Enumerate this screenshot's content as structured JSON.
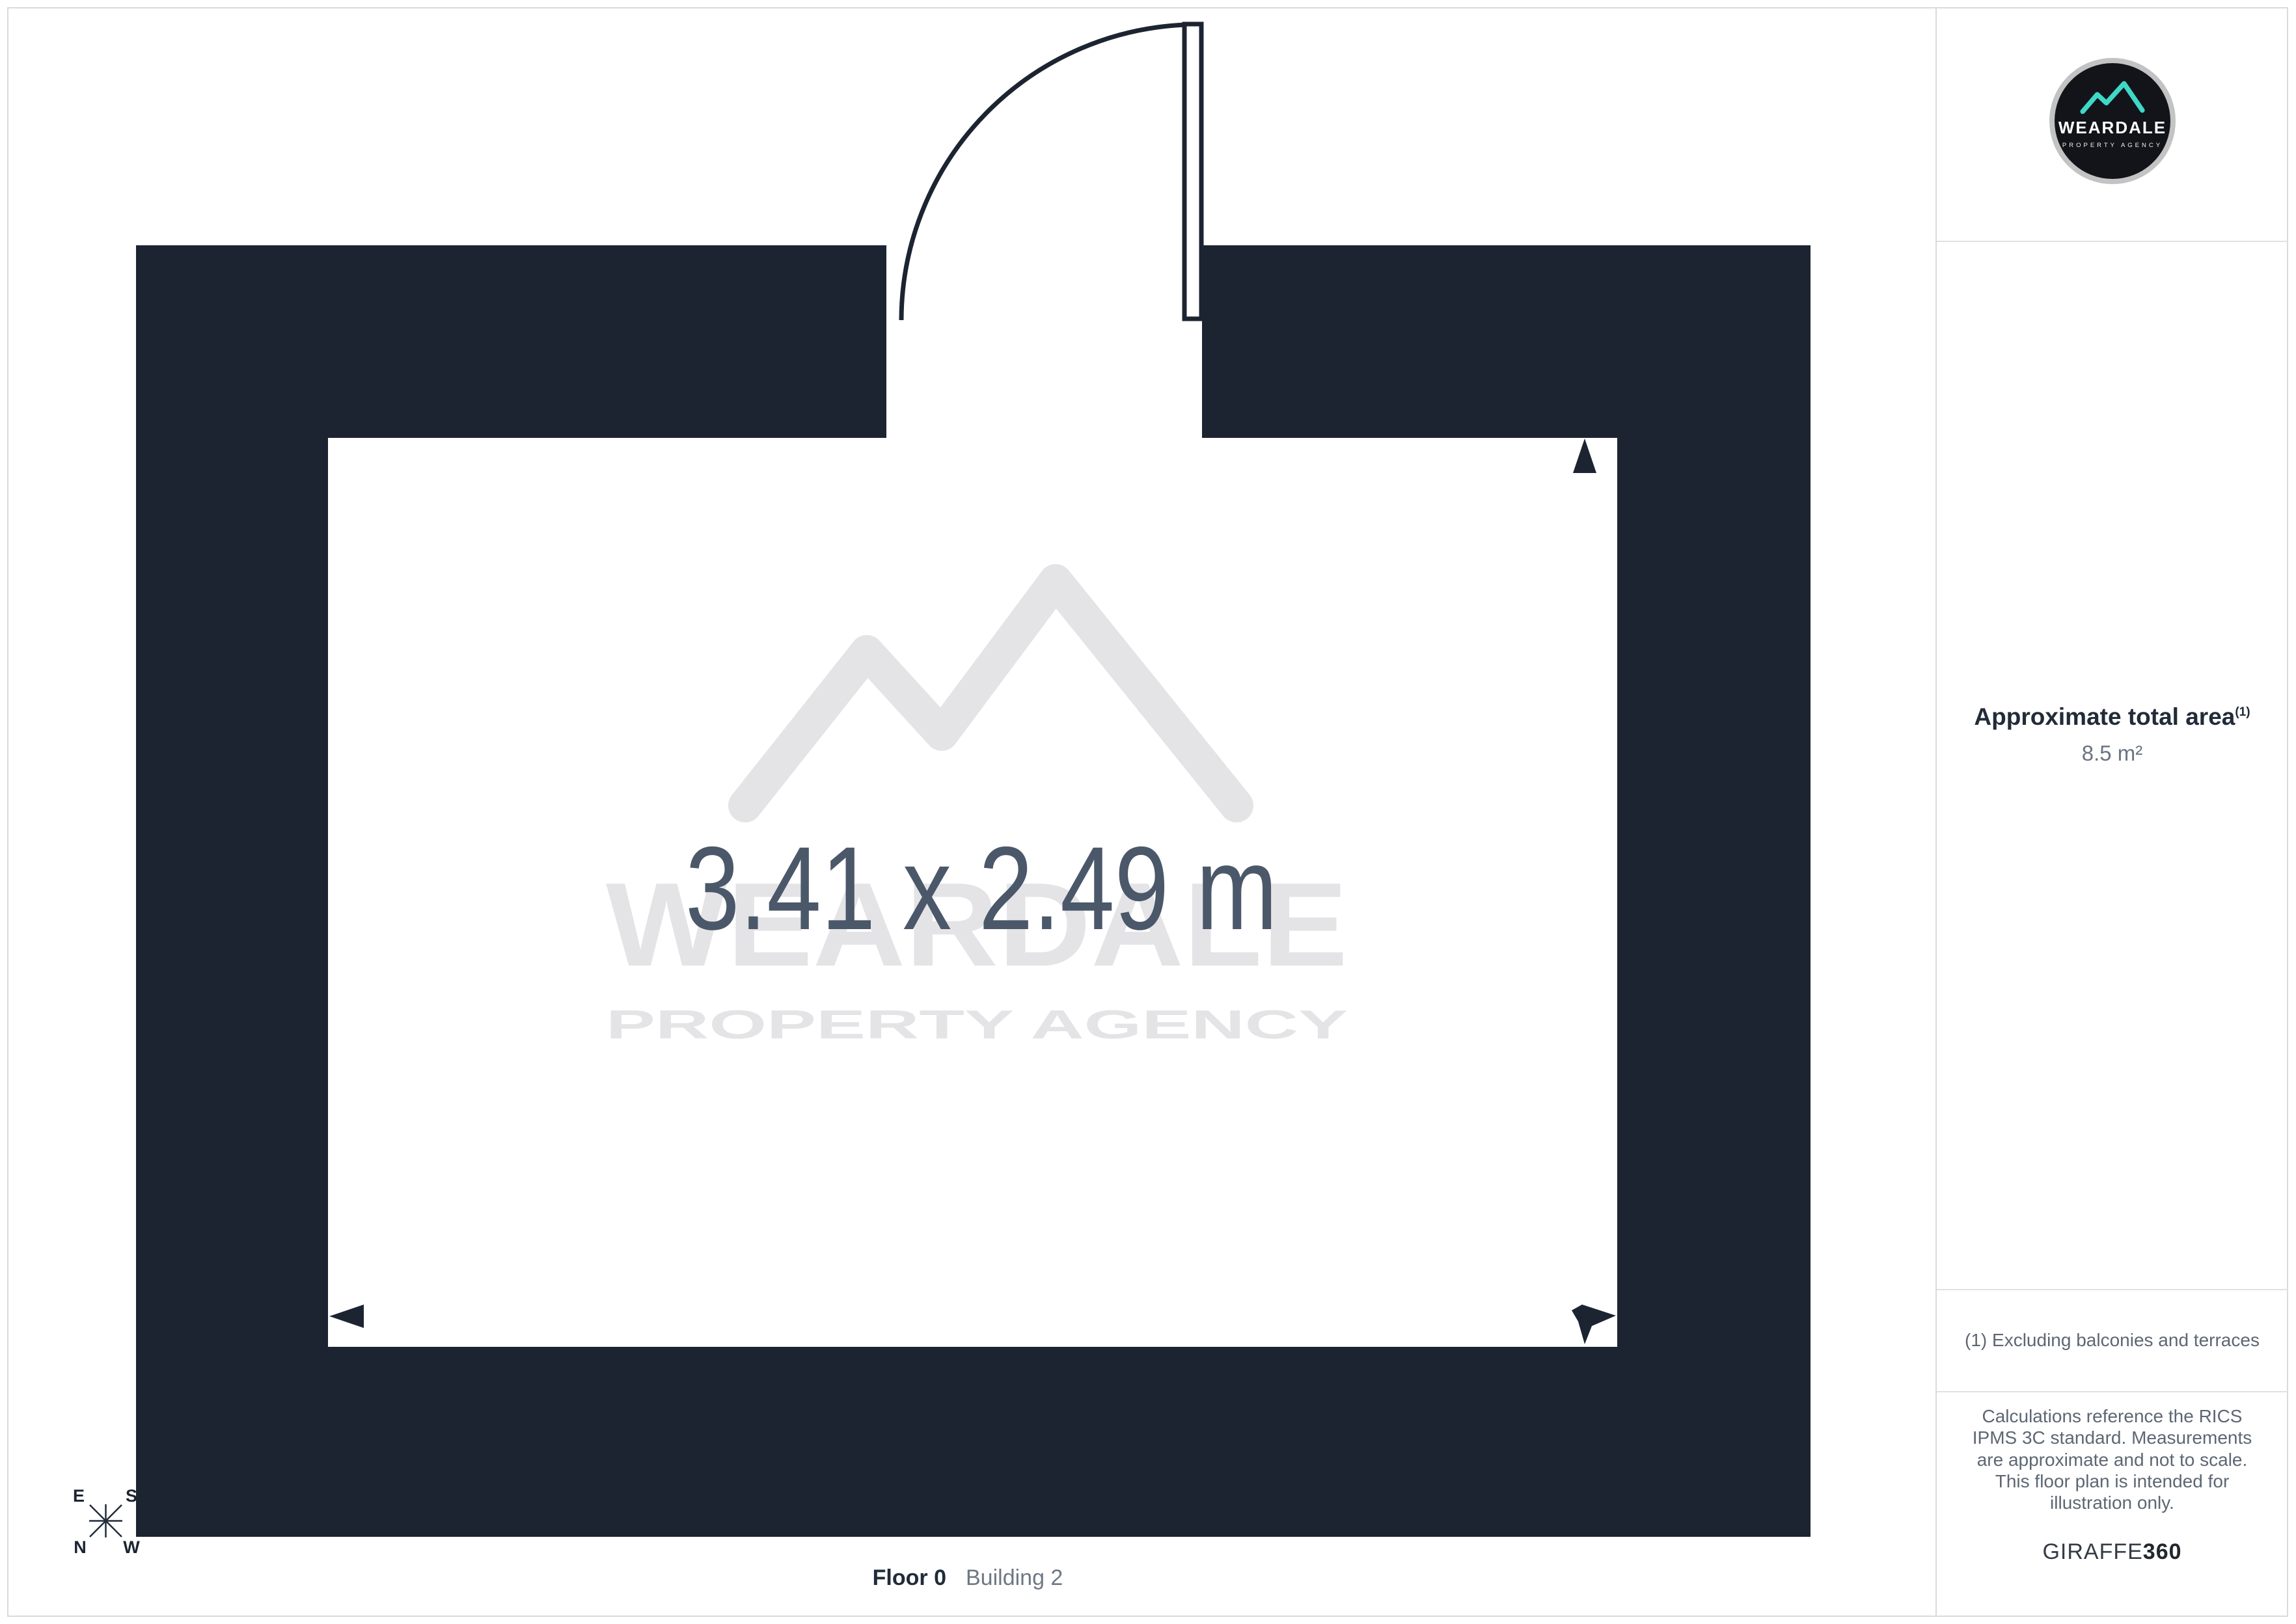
{
  "plan": {
    "room_dimensions": "3.41 x 2.49 m",
    "watermark_brand": "WEARDALE",
    "watermark_tagline": "PROPERTY AGENCY",
    "compass": {
      "top_left": "E",
      "top_right": "S",
      "bottom_left": "N",
      "bottom_right": "W"
    }
  },
  "sidebar": {
    "logo": {
      "brand": "WEARDALE",
      "tagline": "PROPERTY AGENCY"
    },
    "area_heading": "Approximate total area",
    "area_footnote_marker": "(1)",
    "area_value": "8.5 m²",
    "footnote": "(1) Excluding balconies and terraces",
    "disclaimer": "Calculations reference the RICS IPMS 3C standard. Measurements are approximate and not to scale. This floor plan is intended for illustration only.",
    "generator_brand": "GIRAFFE",
    "generator_suffix": "360"
  },
  "footer": {
    "floor": "Floor 0",
    "building": "Building 2"
  },
  "colors": {
    "wall": "#1d2431",
    "accent_teal": "#3fd8c7",
    "dimension_text": "#4b5869",
    "watermark": "#e4e4e7",
    "divider": "#d9dadc"
  }
}
